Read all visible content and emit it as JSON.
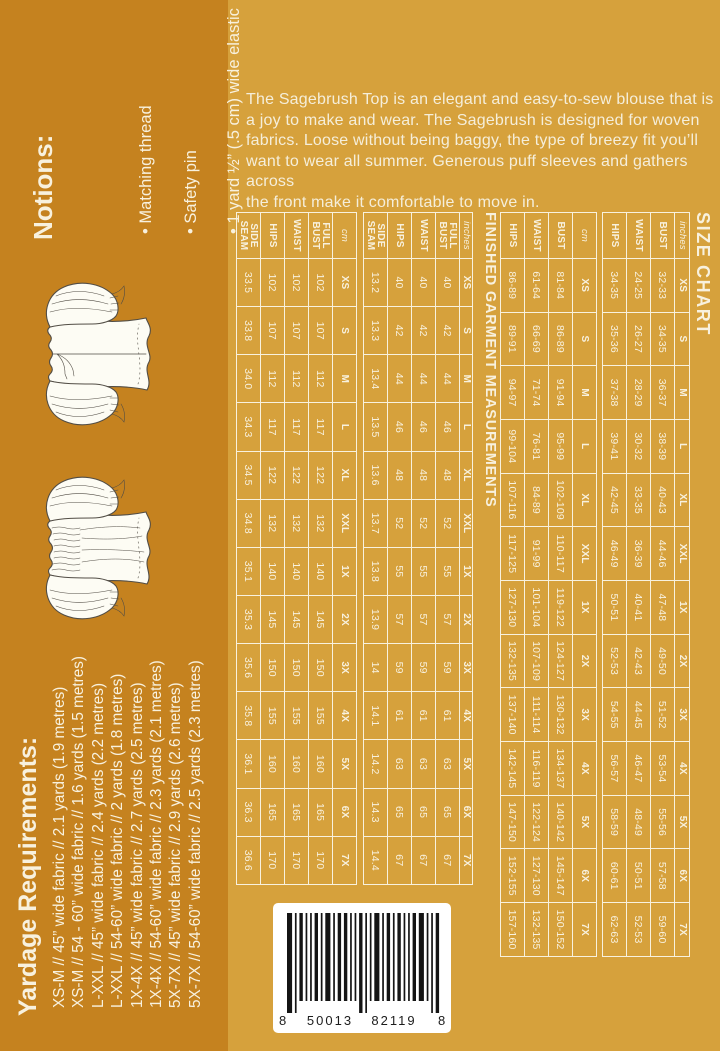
{
  "palette": {
    "bg": "#d6a13c",
    "strip": "#c5821f",
    "ink": "#f8f1de",
    "barcode_bar": "#141414"
  },
  "description_lines": [
    "The Sagebrush Top is an elegant and easy-to-sew blouse that is",
    "a joy to make and wear. The Sagebrush is designed for woven",
    "fabrics. Loose without being baggy, the type of breezy fit you’ll",
    "want to wear all summer. Generous puff sleeves and gathers across",
    "the front make it comfortable to move in."
  ],
  "notions": {
    "title": "Notions:",
    "items": [
      "Matching thread",
      "Safety pin",
      "1 yard ½” (.5 cm) wide elastic"
    ]
  },
  "yardage": {
    "title": "Yardage Requirements:",
    "items": [
      "XS-M // 45” wide fabric // 2.1 yards (1.9 metres)",
      "XS-M // 54 - 60” wide fabric // 1.6 yards (1.5 metres)",
      "L-XXL // 45” wide fabric // 2.4 yards (2.2 metres)",
      "L-XXL // 54-60” wide fabric // 2 yards (1.8 metres)",
      "1X-4X // 45” wide fabric // 2.7 yards (2.5 metres)",
      "1X-4X // 54-60” wide fabric // 2.3 yards (2.1 metres)",
      "5X-7X // 45” wide fabric // 2.9 yards (2.6 metres)",
      "5X-7X // 54-60” wide fabric // 2.5 yards (2.3 metres)"
    ]
  },
  "size_chart": {
    "title": "SIZE CHART",
    "sizes": [
      "XS",
      "S",
      "M",
      "L",
      "XL",
      "XXL",
      "1X",
      "2X",
      "3X",
      "4X",
      "5X",
      "6X",
      "7X"
    ],
    "groups": [
      {
        "unit": "inches",
        "rows": [
          {
            "label": "BUST",
            "values": [
              "32-33",
              "34-35",
              "36-37",
              "38-39",
              "40-43",
              "44-46",
              "47-48",
              "49-50",
              "51-52",
              "53-54",
              "55-56",
              "57-58",
              "59-60"
            ]
          },
          {
            "label": "WAIST",
            "values": [
              "24-25",
              "26-27",
              "28-29",
              "30-32",
              "33-35",
              "36-39",
              "40-41",
              "42-43",
              "44-45",
              "46-47",
              "48-49",
              "50-51",
              "52-53"
            ]
          },
          {
            "label": "HIPS",
            "values": [
              "34-35",
              "35-36",
              "37-38",
              "39-41",
              "42-45",
              "46-49",
              "50-51",
              "52-53",
              "54-55",
              "56-57",
              "58-59",
              "60-61",
              "62-63"
            ]
          }
        ]
      },
      {
        "unit": "cm",
        "rows": [
          {
            "label": "BUST",
            "values": [
              "81-84",
              "86-89",
              "91-94",
              "95-99",
              "102-109",
              "110-117",
              "119-122",
              "124-127",
              "130-132",
              "134-137",
              "140-142",
              "145-147",
              "150-152"
            ]
          },
          {
            "label": "WAIST",
            "values": [
              "61-64",
              "66-69",
              "71-74",
              "76-81",
              "84-89",
              "91-99",
              "101-104",
              "107-109",
              "111-114",
              "116-119",
              "122-124",
              "127-130",
              "132-135"
            ]
          },
          {
            "label": "HIPS",
            "values": [
              "86-89",
              "89-91",
              "94-97",
              "99-104",
              "107-116",
              "117-125",
              "127-130",
              "132-135",
              "137-140",
              "142-145",
              "147-150",
              "152-155",
              "157-160"
            ]
          }
        ]
      }
    ]
  },
  "finished_garment": {
    "title": "FINISHED GARMENT MEASUREMENTS",
    "sizes": [
      "XS",
      "S",
      "M",
      "L",
      "XL",
      "XXL",
      "1X",
      "2X",
      "3X",
      "4X",
      "5X",
      "6X",
      "7X"
    ],
    "groups": [
      {
        "unit": "inches",
        "rows": [
          {
            "label": "FULL BUST",
            "values": [
              "40",
              "42",
              "44",
              "46",
              "48",
              "52",
              "55",
              "57",
              "59",
              "61",
              "63",
              "65",
              "67"
            ]
          },
          {
            "label": "WAIST",
            "values": [
              "40",
              "42",
              "44",
              "46",
              "48",
              "52",
              "55",
              "57",
              "59",
              "61",
              "63",
              "65",
              "67"
            ]
          },
          {
            "label": "HIPS",
            "values": [
              "40",
              "42",
              "44",
              "46",
              "48",
              "52",
              "55",
              "57",
              "59",
              "61",
              "63",
              "65",
              "67"
            ]
          },
          {
            "label": "SIDE SEAM",
            "values": [
              "13.2",
              "13.3",
              "13.4",
              "13.5",
              "13.6",
              "13.7",
              "13.8",
              "13.9",
              "14",
              "14.1",
              "14.2",
              "14.3",
              "14.4"
            ]
          }
        ]
      },
      {
        "unit": "cm",
        "rows": [
          {
            "label": "FULL BUST",
            "values": [
              "102",
              "107",
              "112",
              "117",
              "122",
              "132",
              "140",
              "145",
              "150",
              "155",
              "160",
              "165",
              "170"
            ]
          },
          {
            "label": "WAIST",
            "values": [
              "102",
              "107",
              "112",
              "117",
              "122",
              "132",
              "140",
              "145",
              "150",
              "155",
              "160",
              "165",
              "170"
            ]
          },
          {
            "label": "HIPS",
            "values": [
              "102",
              "107",
              "112",
              "117",
              "122",
              "132",
              "140",
              "145",
              "150",
              "155",
              "160",
              "165",
              "170"
            ]
          },
          {
            "label": "SIDE SEAM",
            "values": [
              "33.5",
              "33.8",
              "34.0",
              "34.3",
              "34.5",
              "34.8",
              "35.1",
              "35.3",
              "35.6",
              "35.8",
              "36.1",
              "36.3",
              "36.6"
            ]
          }
        ]
      }
    ]
  },
  "barcode": {
    "left_digit": "8",
    "group1": "50013",
    "group2": "82119",
    "right_digit": "8"
  }
}
